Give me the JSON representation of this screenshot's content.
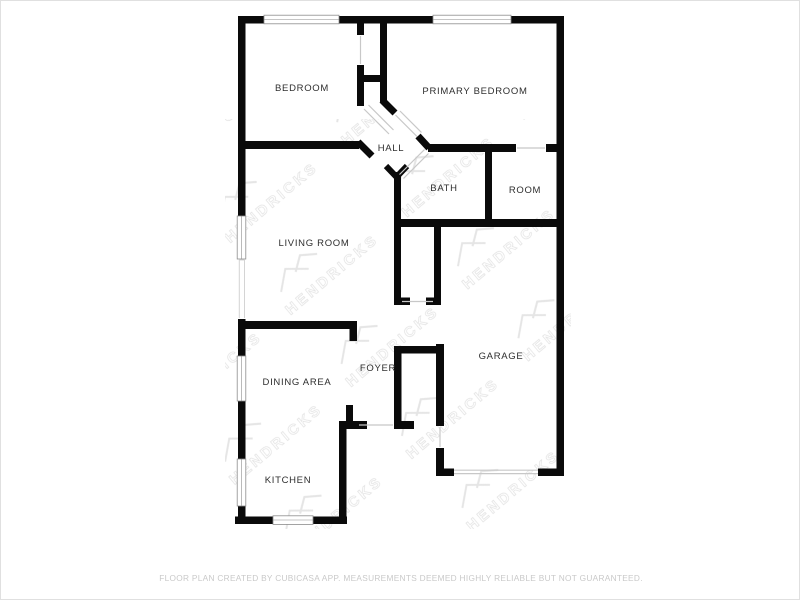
{
  "page": {
    "background": "#ffffff",
    "border_color": "#e0e0e0"
  },
  "floorplan": {
    "wall_color": "#0a0a0a",
    "watermark": {
      "text": "HENDRICKS",
      "color": "#e2e2e2"
    },
    "rooms": [
      {
        "id": "bedroom",
        "label": "BEDROOM",
        "x": 301,
        "y": 90
      },
      {
        "id": "primary-bedroom",
        "label": "PRIMARY BEDROOM",
        "x": 474,
        "y": 93
      },
      {
        "id": "hall",
        "label": "HALL",
        "x": 390,
        "y": 150
      },
      {
        "id": "bath",
        "label": "BATH",
        "x": 443,
        "y": 190
      },
      {
        "id": "room",
        "label": "ROOM",
        "x": 524,
        "y": 192
      },
      {
        "id": "living-room",
        "label": "LIVING ROOM",
        "x": 313,
        "y": 245
      },
      {
        "id": "garage",
        "label": "GARAGE",
        "x": 500,
        "y": 358
      },
      {
        "id": "foyer",
        "label": "FOYER",
        "x": 377,
        "y": 370
      },
      {
        "id": "dining-area",
        "label": "DINING AREA",
        "x": 296,
        "y": 384
      },
      {
        "id": "kitchen",
        "label": "KITCHEN",
        "x": 287,
        "y": 482
      }
    ],
    "footer": {
      "disclaimer": "FLOOR PLAN CREATED BY CUBICASA APP. MEASUREMENTS DEEMED HIGHLY RELIABLE BUT NOT GUARANTEED."
    }
  }
}
